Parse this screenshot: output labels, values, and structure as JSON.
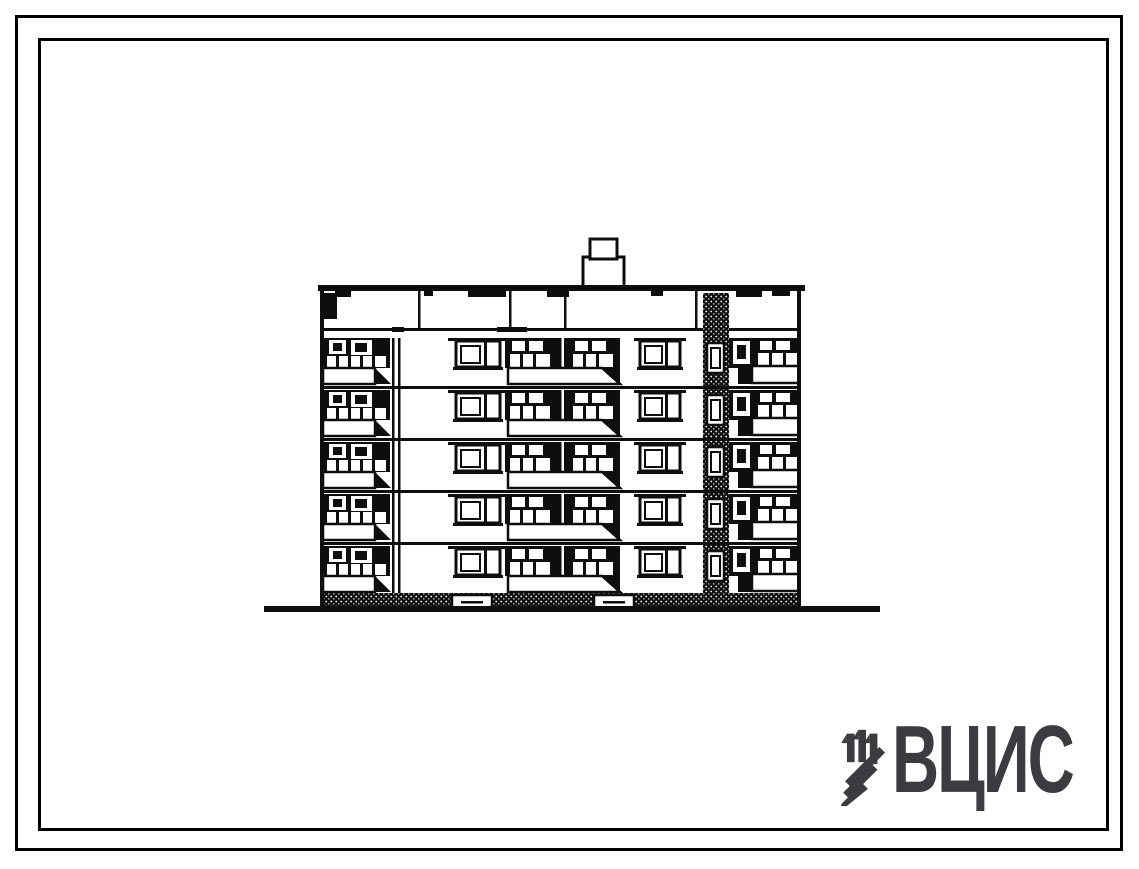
{
  "sheet": {
    "background": "#ffffff",
    "frame_color": "#000000",
    "ink_color": "#0e0e0e"
  },
  "drawing": {
    "kind": "building-end-elevation",
    "floors": 5,
    "features": [
      "chimney",
      "balconies",
      "stairwell-shaft",
      "ground-line",
      "entrance-steps"
    ]
  },
  "logo": {
    "text": "ВЦИС",
    "color": "#3b3b40"
  }
}
